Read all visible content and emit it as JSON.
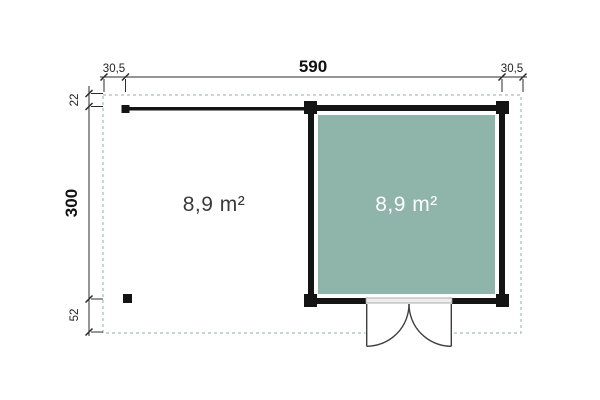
{
  "plan": {
    "dimensions_top": {
      "left_overhang": "30,5",
      "total_width": "590",
      "right_overhang": "30,5"
    },
    "dimensions_left": {
      "top_overhang": "22",
      "total_depth": "300",
      "bottom_overhang": "52"
    },
    "canopy": {
      "area_label": "8,9 m²"
    },
    "cabin": {
      "area_label": "8,9 m²"
    },
    "colors": {
      "cabin_floor": "#8FB4AA",
      "roof_outline": "#A7BFB9",
      "walls": "#141414",
      "dimension_lines": "#2B2B2B"
    }
  }
}
